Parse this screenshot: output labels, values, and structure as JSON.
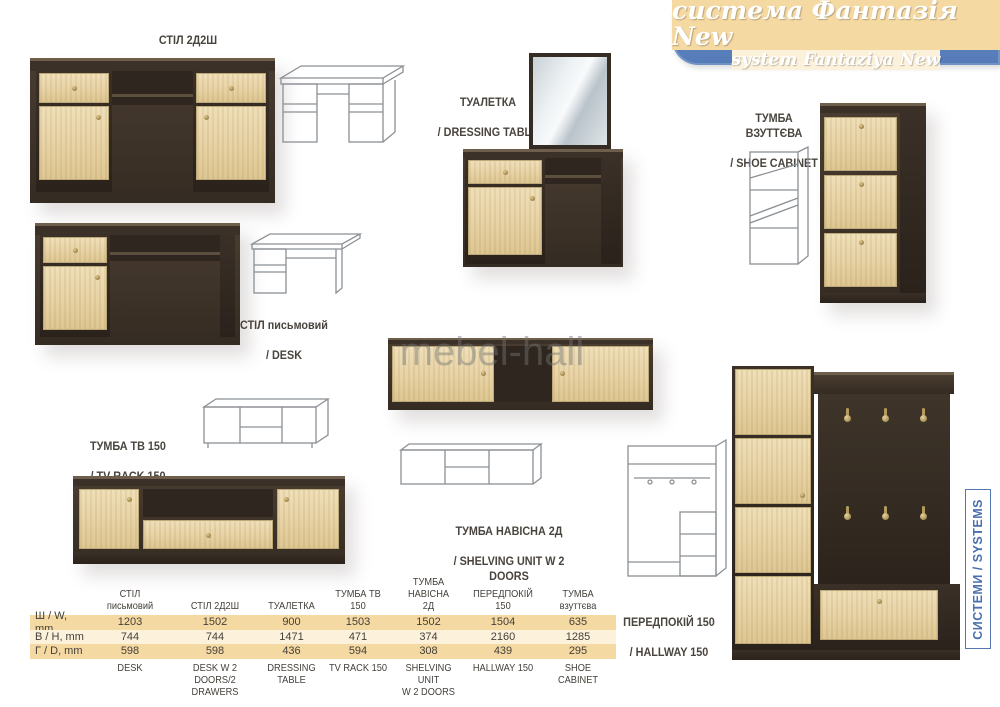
{
  "banner": {
    "title": "система Фантазія New",
    "subtitle": "system Fantaziya New"
  },
  "watermark": "mebel-hall",
  "side_tab": {
    "label": "СИСТЕМИ / SYSTEMS"
  },
  "products": {
    "desk_2d2sh": {
      "name_uk": "СТІЛ 2Д2Ш",
      "name_en": "/ DESK W 2 DOORS/2 DRAWERS"
    },
    "dressing_table": {
      "name_uk": "ТУАЛЕТКА",
      "name_en": "/ DRESSING TABLE"
    },
    "shoe_cabinet": {
      "name_uk": "ТУМБА\nВЗУТТЄВА",
      "name_en": "/ SHOE CABINET"
    },
    "desk": {
      "name_uk": "СТІЛ письмовий",
      "name_en": "/ DESK"
    },
    "tv_rack": {
      "name_uk": "ТУМБА ТВ 150",
      "name_en": "/ TV RACK 150"
    },
    "shelving_unit": {
      "name_uk": "ТУМБА НАВІСНА 2Д",
      "name_en": "/ SHELVING UNIT W 2 DOORS"
    },
    "hallway": {
      "name_uk": "ПЕРЕДПОКІЙ 150",
      "name_en": "/ HALLWAY 150"
    }
  },
  "dimensions_table": {
    "row_labels": [
      "Ш / W, mm",
      "В / H, mm",
      "Г / D, mm"
    ],
    "columns": [
      {
        "uk": "СТІЛ\nписьмовий",
        "en": "DESK",
        "w": "1203",
        "h": "744",
        "d": "598"
      },
      {
        "uk": "СТІЛ 2Д2Ш",
        "en": "DESK W 2 DOORS/2\nDRAWERS",
        "w": "1502",
        "h": "744",
        "d": "598"
      },
      {
        "uk": "ТУАЛЕТКА",
        "en": "DRESSING\nTABLE",
        "w": "900",
        "h": "1471",
        "d": "436"
      },
      {
        "uk": "ТУМБА ТВ\n150",
        "en": "TV RACK 150",
        "w": "1503",
        "h": "471",
        "d": "594"
      },
      {
        "uk": "ТУМБА НАВІСНА\n2Д",
        "en": "SHELVING UNIT\nW 2 DOORS",
        "w": "1502",
        "h": "374",
        "d": "308"
      },
      {
        "uk": "ПЕРЕДПОКІЙ\n150",
        "en": "HALLWAY 150",
        "w": "1504",
        "h": "2160",
        "d": "439"
      },
      {
        "uk": "ТУМБА\nвзуттєва",
        "en": "SHOE\nCABINET",
        "w": "635",
        "h": "1285",
        "d": "295"
      }
    ]
  },
  "colors": {
    "accent_blue": "#5b80bc",
    "table_band": "#f5d9a2",
    "oak": "#e8d5aa",
    "wenge": "#3a3027",
    "label_text": "#4a443e"
  }
}
